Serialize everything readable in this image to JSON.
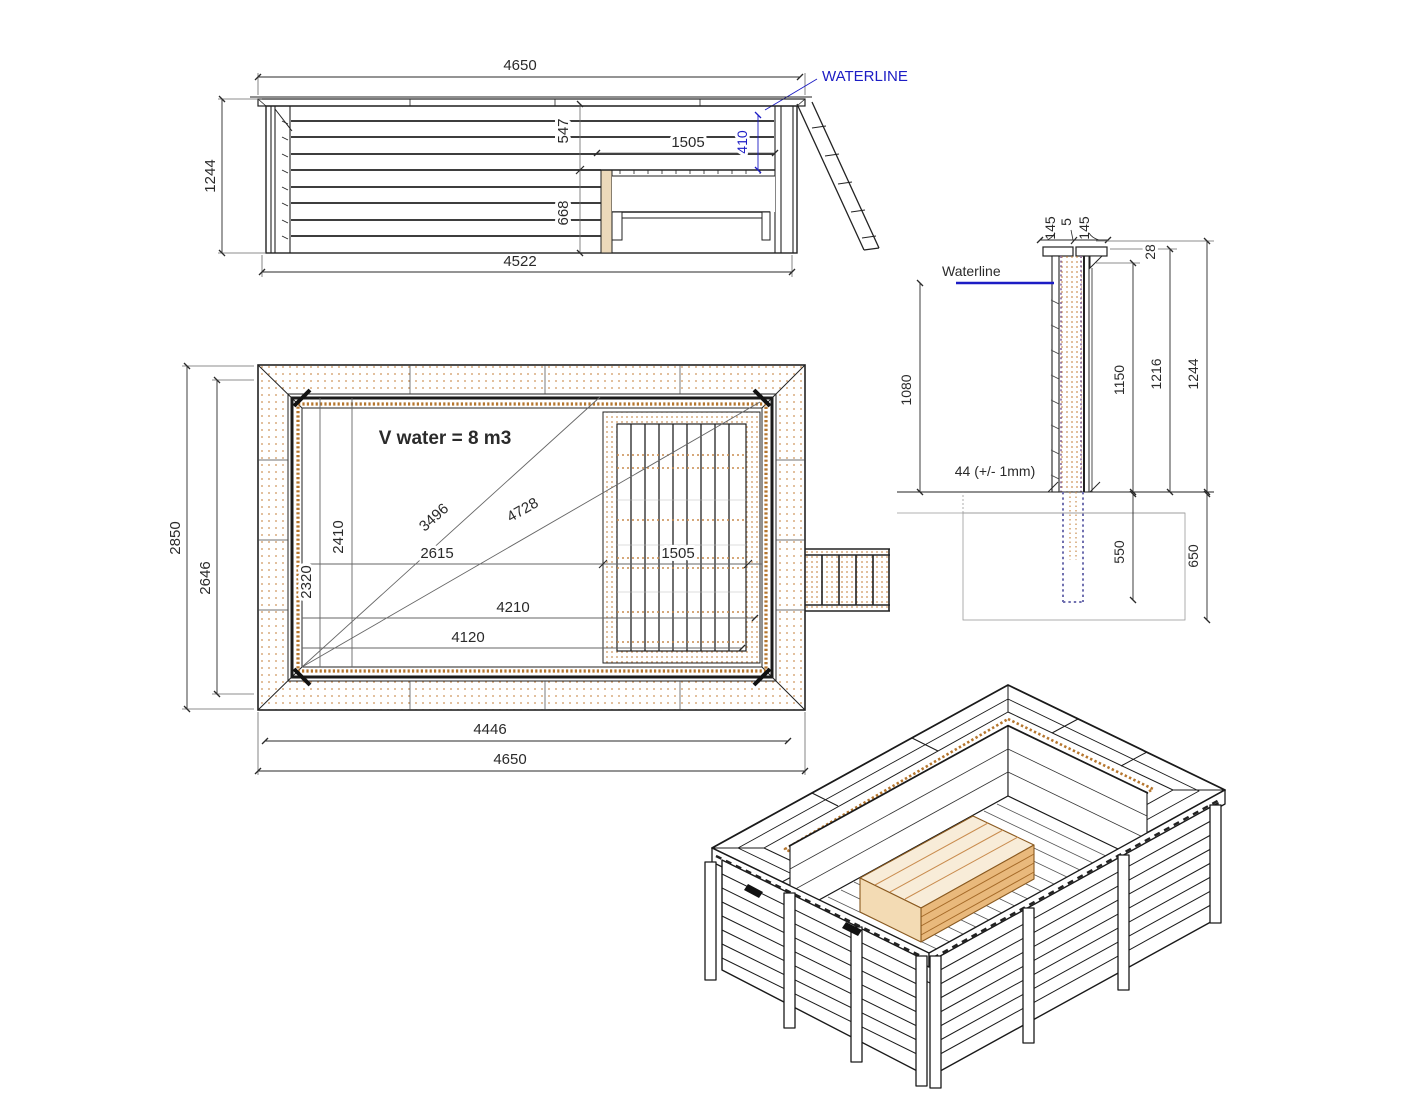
{
  "drawing": {
    "side_view": {
      "waterline_label": "WATERLINE",
      "dim_top_width": "4650",
      "dim_height": "1244",
      "dim_bottom_width": "4522",
      "dim_depth_upper": "547",
      "dim_bench_length": "1505",
      "dim_water_to_bench": "410",
      "dim_bench_lower": "668"
    },
    "plan_view": {
      "volume_label": "V water = 8 m3",
      "dim_outer_width": "2850",
      "dim_inner_width": "2646",
      "dim_offset_a": "2320",
      "dim_offset_b": "2410",
      "dim_diag_inner": "3496",
      "dim_diag_outer": "4728",
      "dim_mid_length": "2615",
      "dim_deck_width": "1505",
      "dim_len_a": "4210",
      "dim_len_b": "4120",
      "dim_inner_length": "4446",
      "dim_outer_length": "4650"
    },
    "section_view": {
      "waterline_label": "Waterline",
      "dim_cap_a": "145",
      "dim_cap_gap": "5",
      "dim_cap_b": "145",
      "dim_cap_thickness": "28",
      "dim_wall_a": "1150",
      "dim_wall_b": "1216",
      "dim_total_height": "1244",
      "dim_water_depth": "1080",
      "dim_pier_depth": "550",
      "dim_footing_depth": "650",
      "dim_plank_thickness": "44 (+/- 1mm)"
    },
    "colors": {
      "line": "#222222",
      "reference_line": "#666666",
      "wood_dot": "#c98c4e",
      "wood_dark": "#a56a28",
      "waterline_blue": "#1c1cc4",
      "pier_dot": "#7070b0",
      "slab_gray": "#999999"
    }
  }
}
